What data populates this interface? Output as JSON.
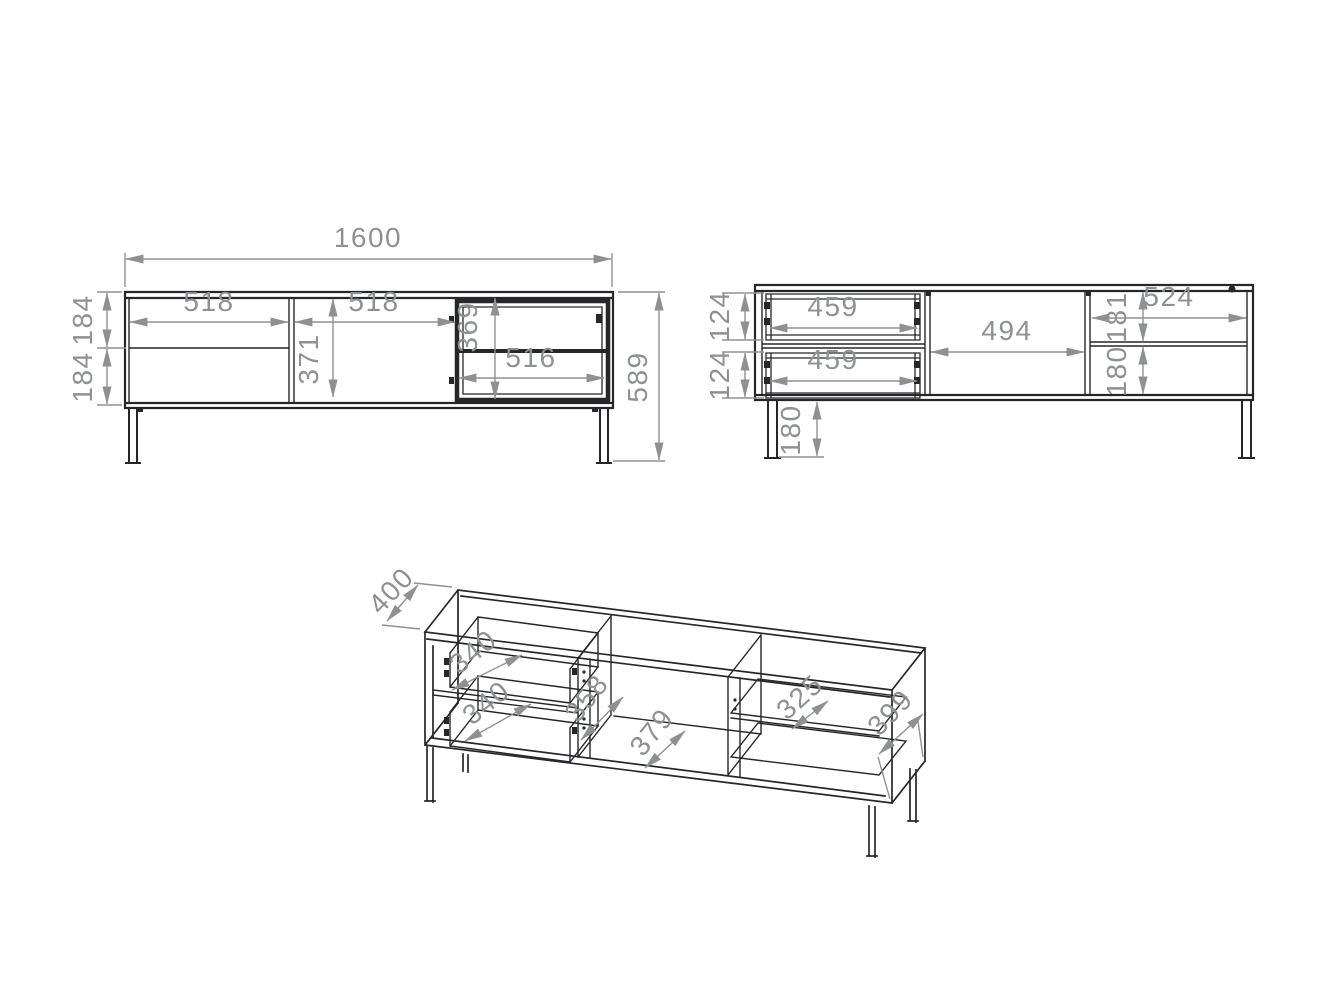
{
  "sheet": {
    "background_color": "#ffffff",
    "line_color": "#26272b",
    "dimension_color": "#8e9194"
  },
  "front_view": {
    "overall_width": "1600",
    "overall_height": "589",
    "drawer_section_width": "518",
    "door_section_width": "518",
    "top_drawer_front_height": "184",
    "bottom_drawer_front_height": "184",
    "door_inner_height": "371",
    "glass_door_height": "369",
    "glass_door_width": "516"
  },
  "back_view": {
    "top_drawer_width": "459",
    "bottom_drawer_width": "459",
    "top_drawer_height": "124",
    "bottom_drawer_height": "124",
    "middle_section_width": "494",
    "right_section_width": "524",
    "right_upper_height": "181",
    "right_lower_height": "180",
    "leg_height": "180"
  },
  "isometric_view": {
    "overall_depth": "400",
    "top_drawer_depth": "340",
    "bottom_drawer_depth": "340",
    "middle_inner_height": "358",
    "middle_inner_width": "379",
    "shelf_depth": "325",
    "side_depth": "399"
  }
}
